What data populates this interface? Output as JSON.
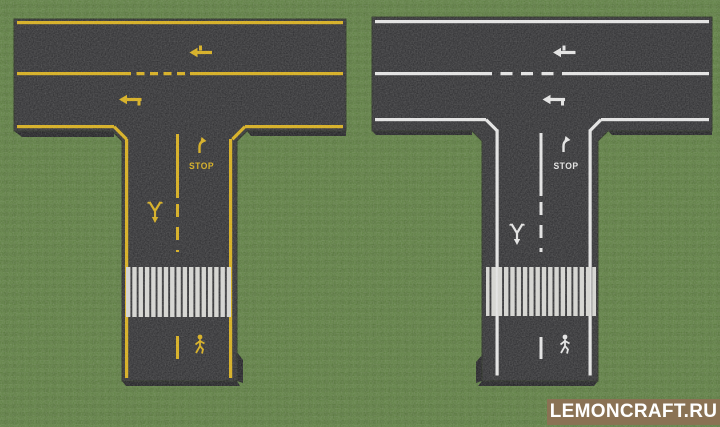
{
  "colors": {
    "grass": "#57793a",
    "asphalt": "#2a2a2d",
    "marking-left": "#d9ad10",
    "marking-right": "#e8e8e8",
    "crosswalk": "#d8d8d4",
    "side": "#1a1a1d",
    "wm-bg": "#8a7254",
    "wm-text": "#ffffff"
  },
  "scene": {
    "environment": "grass-field",
    "roads": [
      {
        "name": "t-intersection-road-yellow-markings",
        "marking_color": "#d9ad10",
        "stop_label": "STOP",
        "markings": [
          "edge-line",
          "center-line-with-dashes",
          "lane-arrow-upper",
          "lane-arrow-lower",
          "stop-divider-line",
          "turn-right-arrow",
          "stop-text",
          "merge-arrow",
          "zebra-crosswalk",
          "pedestrian-symbol"
        ]
      },
      {
        "name": "t-intersection-road-white-markings",
        "marking_color": "#e8e8e8",
        "stop_label": "STOP",
        "markings": [
          "edge-line",
          "center-line-with-dashes",
          "lane-arrow-upper",
          "lane-arrow-lower",
          "stop-divider-line",
          "turn-right-arrow",
          "stop-text",
          "merge-arrow",
          "zebra-crosswalk",
          "pedestrian-symbol"
        ]
      }
    ]
  },
  "watermark": {
    "text": "LEMONCRAFT.RU"
  }
}
